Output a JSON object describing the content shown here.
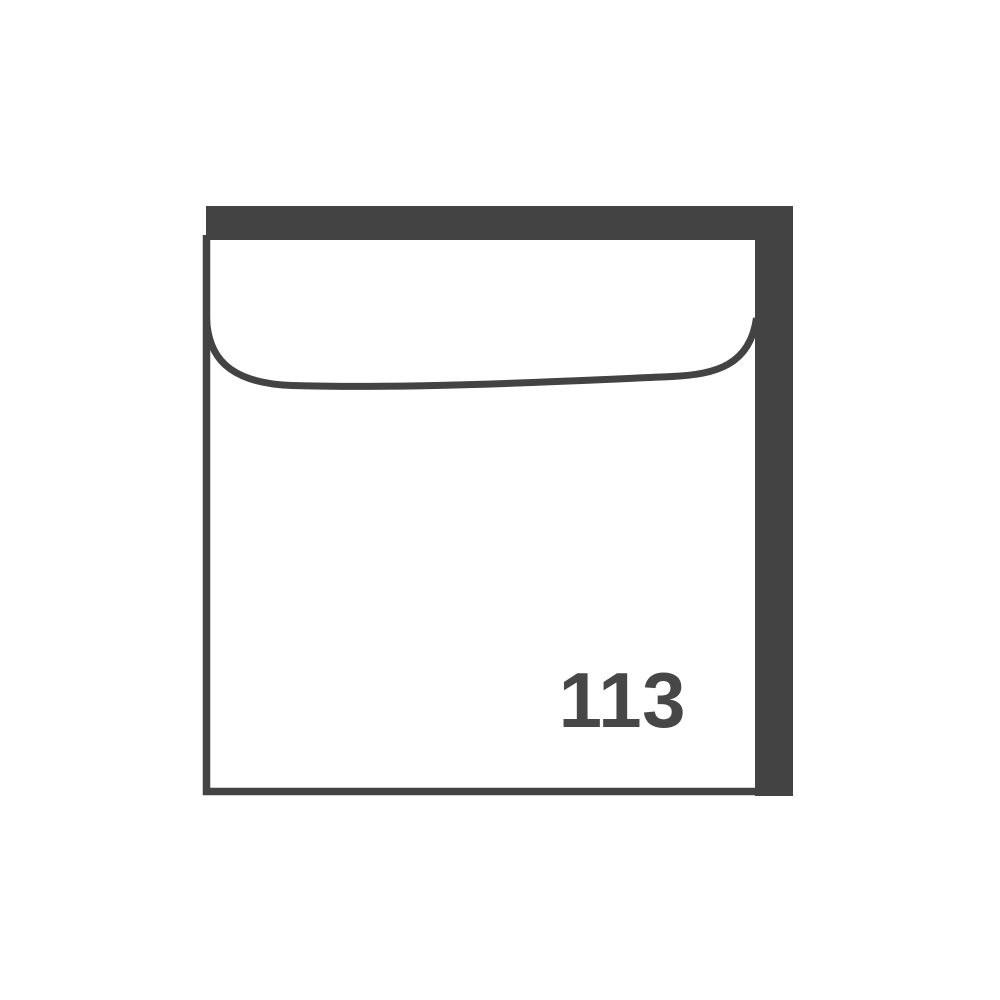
{
  "figure": {
    "type": "envelope-pictogram",
    "number": "113",
    "colors": {
      "ink": "#434343",
      "number_ink": "#474747",
      "paper": "#ffffff",
      "background": "#ffffff"
    }
  }
}
